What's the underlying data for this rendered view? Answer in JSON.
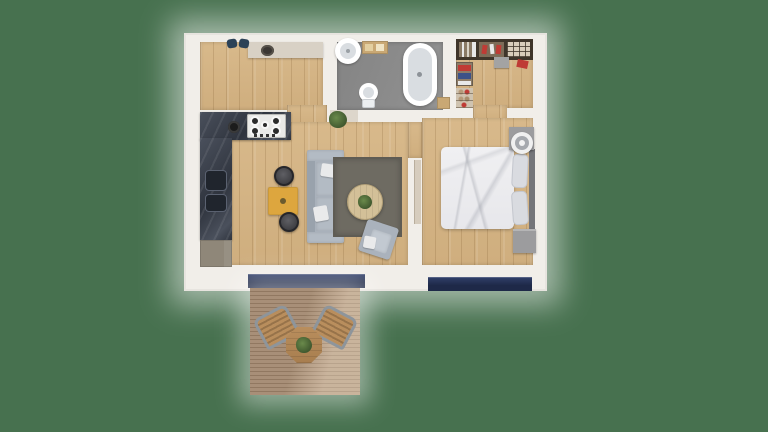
{
  "scene": {
    "type": "3d-floor-plan-top-view",
    "description": "Photoreal top-down render of a one-bedroom apartment with attached wooden deck on a plain green backdrop. No visible text, labels or UI controls.",
    "rooms": [
      {
        "name": "utility-kitchenette",
        "floor": "light-oak-plank",
        "features": [
          "stone-counter-with-round-sink",
          "two-navy-stools"
        ]
      },
      {
        "name": "bathroom",
        "floor": "gray-screed",
        "features": [
          "round-pedestal-basin",
          "wooden-bench",
          "toilet",
          "freestanding-oval-bathtub",
          "corner-wood-shelf"
        ]
      },
      {
        "name": "walk-in-closet",
        "floor": "light-oak-plank",
        "features": [
          "wall-rack-with-hanging-clothes",
          "folded-clothes-cubby",
          "shoe-shelf",
          "storage-box",
          "red-garment"
        ]
      },
      {
        "name": "living-room-open-kitchen",
        "floor": "light-oak-plank",
        "features": [
          "dark-marble-l-counter",
          "gas-hob-5-burner",
          "double-basin-sink",
          "black-pot",
          "gray-base-cabinet",
          "yellow-dining-table",
          "two-round-stools",
          "gray-sofa-two-white-pillows",
          "gray-rug",
          "round-wood-coffee-table-with-plant",
          "gray-armchair",
          "potted-plant"
        ]
      },
      {
        "name": "bedroom",
        "floor": "light-oak-plank",
        "features": [
          "unmade-double-bed",
          "two-gray-pillows",
          "dark-headboard",
          "nightstand-with-round-fan",
          "second-nightstand",
          "open-door-leaf"
        ]
      },
      {
        "name": "outdoor-deck",
        "floor": "slatted-wood-planks",
        "features": [
          "octagonal-bistro-table-with-plant",
          "two-angled-slat-chairs",
          "sunlight-patch"
        ]
      }
    ],
    "openings": [
      "pantry-to-living-doorway",
      "bathroom-door-threshold",
      "closet-to-bedroom-doorway",
      "living-to-bedroom-doorway",
      "living-glass-slider",
      "bedroom-window-strip"
    ],
    "colors": {
      "bg": "#47714F",
      "wall": "#f1eee9",
      "wood": "#d8b98b",
      "woodDark": "#cfae7e",
      "bathFloor": "#8c8c8c",
      "threshold": "#ddd6cb",
      "stoneCounter": "#d8d1c5",
      "marbleLight": "#4a505c",
      "marbleDark": "#2f343e",
      "sinkDark": "#20252d",
      "stovePanel": "#e9e9e7",
      "cabinet": "#8f8779",
      "yellow": "#dda63e",
      "stool": "#3e3e42",
      "sofa": "#a9b1bb",
      "sofaLight": "#b3bbc4",
      "sofaBack": "#99a2ac",
      "rug": "#6e6b62",
      "rugEdge": "#5f5c54",
      "tableWood": "#d3c098",
      "plant": "#41592f",
      "armchair": "#aab2bc",
      "pillowWhite": "#e9eaeb",
      "bedding": "#e7e7eb",
      "bedPillow": "#d9dbe0",
      "headboard": "#75767a",
      "nightstand": "#9c9c9e",
      "doorLeaf": "#d6ccbd",
      "glass": "#1e2948",
      "glassLight": "#31406b",
      "deckPlank": "#b2987f",
      "deckGap": "#9a8067",
      "deckTable": "#b98e5d",
      "chairFrame": "#8e959b",
      "shelfFrame": "#3f352a",
      "clothesRed": "#bf3b35",
      "clothesBlue": "#3d5288",
      "clothesWhite": "#e8e8e8",
      "shoeShelf": "#cfc3b0",
      "boxGray": "#a3a3a3",
      "tubInner": "#d9dde1",
      "blueItem": "#2c4257",
      "benchWood": "#c9a874",
      "white": "#ffffff"
    }
  }
}
